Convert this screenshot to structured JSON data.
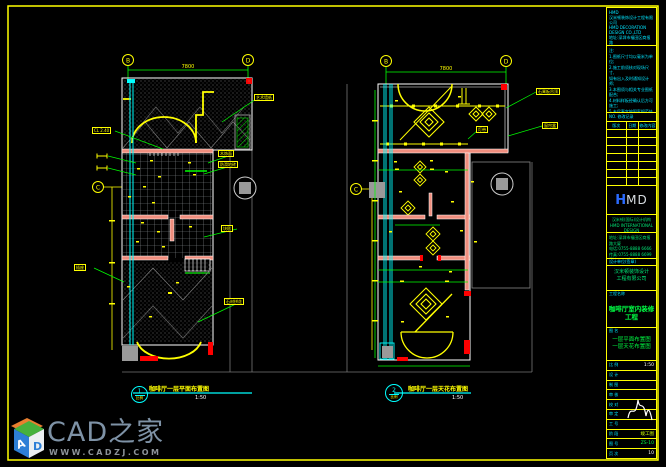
{
  "accent_colors": {
    "line_yellow": "#ffff00",
    "dim_green": "#00ff00",
    "glass_cyan": "#00ffff",
    "wall_salmon": "#ef8e7e",
    "marker_red": "#ff0000",
    "context_gray": "#8a8f94"
  },
  "plans": [
    {
      "number": "1",
      "title": "咖啡厅一层平面布置图",
      "scale": "1:50",
      "bubble_scale": "比例",
      "dim_top": "7800",
      "grid": {
        "top_left": "B",
        "top_right": "D",
        "side": "C"
      }
    },
    {
      "number": "2",
      "title": "咖啡厅一层天花布置图",
      "scale": "1:50",
      "bubble_scale": "比例",
      "dim_top": "7800",
      "grid": {
        "top_left": "B",
        "top_right": "D",
        "side": "C"
      }
    }
  ],
  "labels": {
    "p1": [
      "CL 2.40",
      "插座",
      "艺术墙纸",
      "木饰面",
      "防滑地砖",
      "块毯",
      "石材拼花"
    ],
    "p2": [
      "石膏板吊顶",
      "窗帘盒",
      "灯带"
    ]
  },
  "watermark": {
    "brand": "CAD之家",
    "url": "WWW.CADZJ.COM",
    "cube_letters": {
      "left": "A",
      "right": "D"
    }
  },
  "titleblock": {
    "firm_block": [
      "HMD",
      "汉米顿装饰设计工程有限公司",
      "HMD DECORATION DESIGN CO.,LTD",
      "地址:深圳市福田区商报路",
      "电话:0755-8888 6666",
      "传真:0755-8888 6699"
    ],
    "notes_block": [
      "注:",
      "1.图纸尺寸均以毫米为单位;",
      "2.施工前须核对现场尺寸,",
      "如有出入及时通知设计师;",
      "3.本图须与相关专业图纸配合;",
      "4.材料样板经确认后方可施工;",
      "5.未尽事宜按国家规范执行."
    ],
    "rev_caption": "NO. 修改记录",
    "rev_headers": [
      "版次",
      "日期",
      "修改内容"
    ],
    "logo": {
      "h": "H",
      "md": "MD"
    },
    "brand_lines": [
      "汉米顿(国际)设计机构",
      "HMD INTERNATIONAL DESIGN"
    ],
    "addr_lines": [
      "地址:深圳市福田区商报路大厦",
      "电话:0755-8888 6666",
      "传真:0755-8888 6699",
      "网址:www.hmd-design.com"
    ],
    "approve": {
      "label": "设计单位(签章)",
      "lines": [
        "汉米顿装饰设计",
        "工程有限公司"
      ]
    },
    "project": {
      "label": "工程名称",
      "name": "咖啡厅室内装修工程"
    },
    "drawing": {
      "label": "图 名",
      "lines": [
        "一层平面布置图",
        "一层天花布置图"
      ]
    },
    "rows": [
      {
        "label": "比 例",
        "value": "1:50"
      },
      {
        "label": "设 计",
        "value": ""
      },
      {
        "label": "制 图",
        "value": ""
      },
      {
        "label": "审 核",
        "value": ""
      },
      {
        "label": "校 对",
        "value": ""
      },
      {
        "label": "审 定",
        "value": ""
      },
      {
        "label": "工 号",
        "value": ""
      },
      {
        "label": "阶 段",
        "value": "竣工图"
      },
      {
        "label": "图 号",
        "value": "ZS-10"
      },
      {
        "label": "页 次",
        "value": "10"
      }
    ]
  }
}
